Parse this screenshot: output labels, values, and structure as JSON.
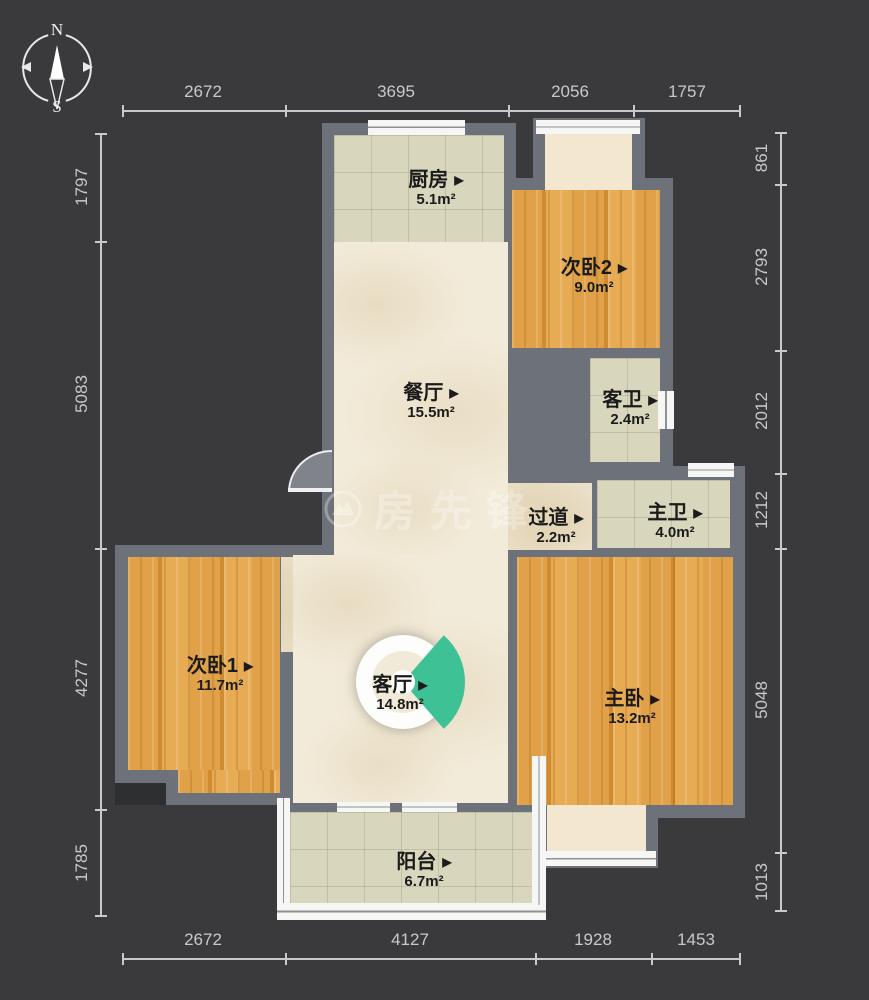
{
  "ui": {
    "arrow": "▶"
  },
  "compass": {
    "north": "N",
    "south": "S"
  },
  "watermark": {
    "brand": "房先锋"
  },
  "rooms": [
    {
      "id": "kitchen",
      "name": "厨房",
      "area": "5.1m²"
    },
    {
      "id": "bedroom2",
      "name": "次卧2",
      "area": "9.0m²"
    },
    {
      "id": "dining",
      "name": "餐厅",
      "area": "15.5m²"
    },
    {
      "id": "guest-bath",
      "name": "客卫",
      "area": "2.4m²"
    },
    {
      "id": "hallway",
      "name": "过道",
      "area": "2.2m²"
    },
    {
      "id": "master-bath",
      "name": "主卫",
      "area": "4.0m²"
    },
    {
      "id": "bedroom1",
      "name": "次卧1",
      "area": "11.7m²"
    },
    {
      "id": "living",
      "name": "客厅",
      "area": "14.8m²"
    },
    {
      "id": "master",
      "name": "主卧",
      "area": "13.2m²"
    },
    {
      "id": "balcony",
      "name": "阳台",
      "area": "6.7m²"
    }
  ],
  "dimensions": {
    "top": [
      "2672",
      "3695",
      "2056",
      "1757"
    ],
    "bottom": [
      "2672",
      "4127",
      "1928",
      "1453"
    ],
    "left": [
      "1797",
      "5083",
      "4277",
      "1785"
    ],
    "right": [
      "861",
      "2793",
      "2012",
      "1212",
      "5048",
      "1013"
    ]
  },
  "colors": {
    "background": "#3A3A3C",
    "wall": "#6D717A",
    "wood_floor": "#DB9A3F",
    "tile_floor": "#D8D6BD",
    "marble_floor": "#F2EBD9",
    "view_cone_teal": "#3EC295",
    "dimension_text": "#C9C9C9"
  }
}
